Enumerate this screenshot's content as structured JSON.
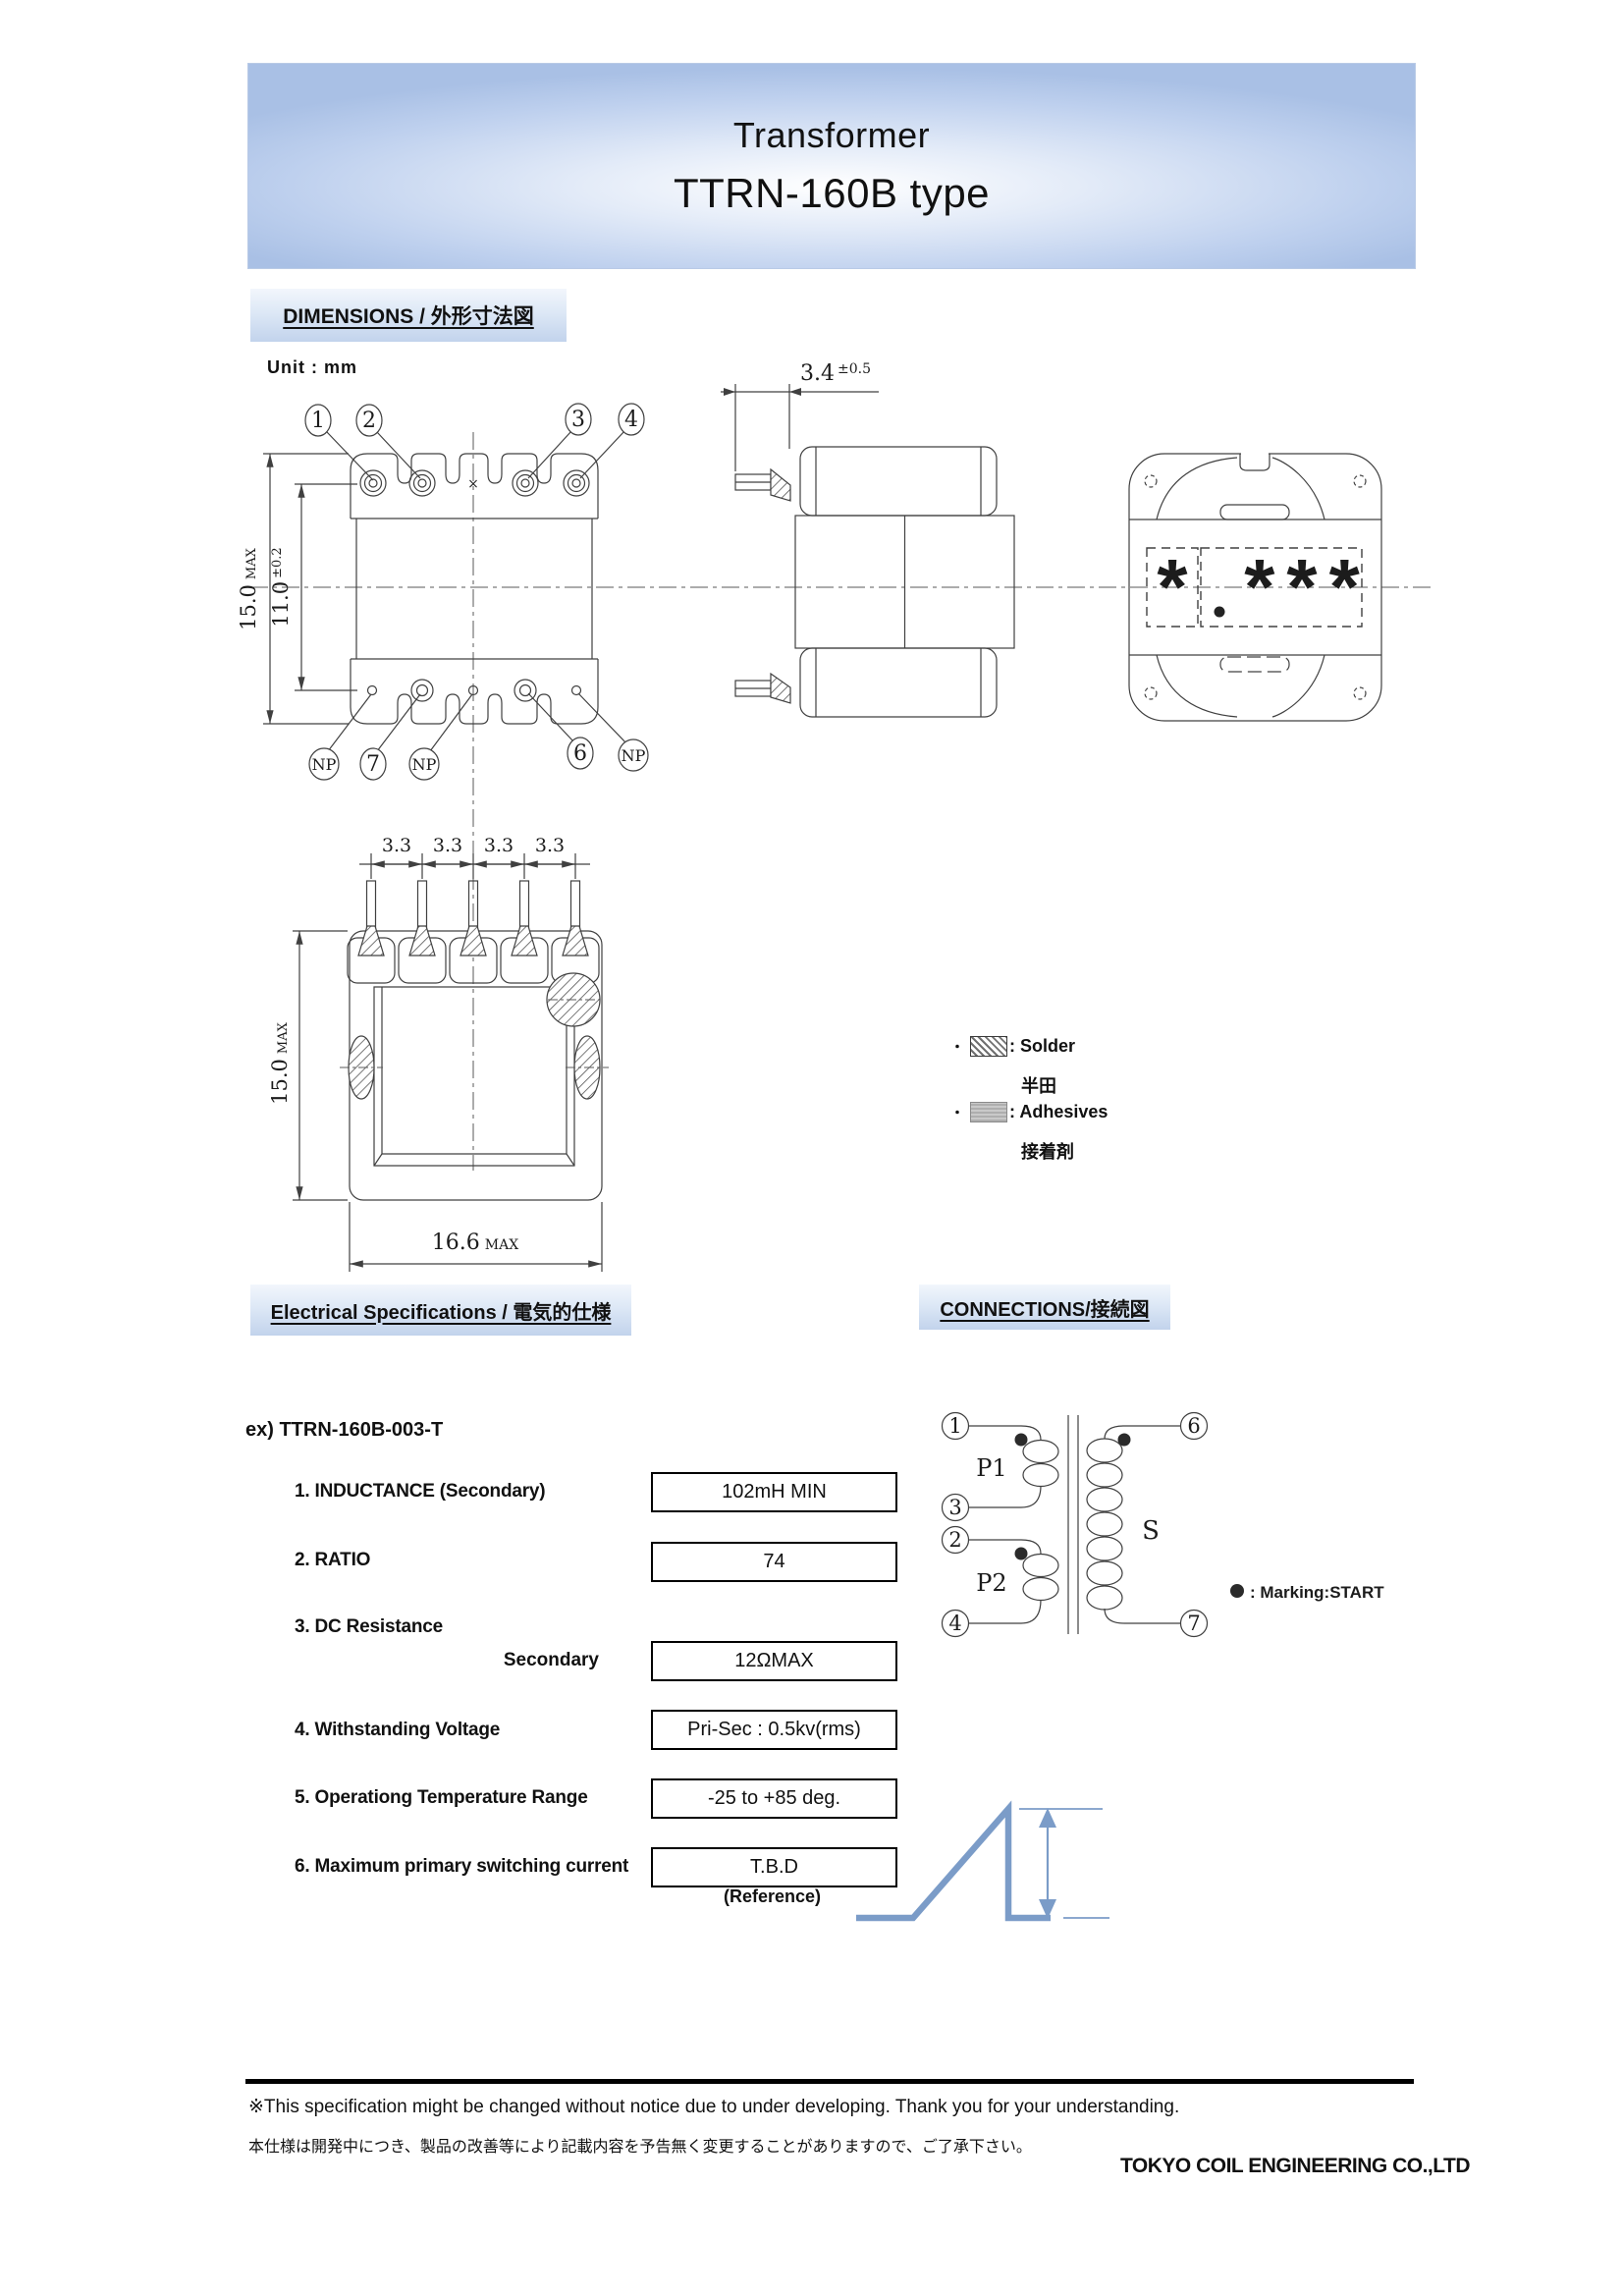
{
  "header": {
    "product": "Transformer",
    "model": "TTRN-160B type"
  },
  "section_dimensions": {
    "title": "DIMENSIONS / 外形寸法図",
    "unit_label": "Unit : mm"
  },
  "top_view": {
    "callouts_top": [
      "1",
      "2",
      "3",
      "4"
    ],
    "callouts_bottom": [
      "NP",
      "7",
      "NP",
      "6",
      "NP"
    ],
    "dim_outer": {
      "value": "15.0",
      "suffix": "MAX"
    },
    "dim_inner": {
      "value": "11.0",
      "suffix": "±0.2"
    },
    "center_mark": "×"
  },
  "side_view": {
    "dim_pin": {
      "value": "3.4",
      "suffix": "±0.5"
    }
  },
  "back_view": {
    "marking_left": "*",
    "marking_right": "***"
  },
  "front_view": {
    "pitch_labels": [
      "3.3",
      "3.3",
      "3.3",
      "3.3"
    ],
    "dim_height": {
      "value": "15.0",
      "suffix": "MAX"
    },
    "dim_width": {
      "value": "16.6",
      "suffix": "MAX"
    }
  },
  "legend": {
    "bullet": "・",
    "solder_label": ": Solder",
    "solder_jp": "半田",
    "adhesives_label": ": Adhesives",
    "adhesives_jp": "接着剤"
  },
  "section_electrical": {
    "title": "Electrical Specifications / 電気的仕様",
    "example": "ex) TTRN-160B-003-T"
  },
  "section_connections": {
    "title": "CONNECTIONS/接続図"
  },
  "specs": [
    {
      "label": "1. INDUCTANCE (Secondary)",
      "value": "102mH MIN"
    },
    {
      "label": "2. RATIO",
      "value": "74"
    },
    {
      "label": "3. DC Resistance",
      "sublabel": "Secondary",
      "value": "12ΩMAX"
    },
    {
      "label": "4. Withstanding Voltage",
      "value": "Pri-Sec : 0.5kv(rms)"
    },
    {
      "label": "5. Operationg Temperature Range",
      "value": "-25 to +85 deg."
    },
    {
      "label": "6. Maximum primary switching current",
      "value": "T.B.D",
      "note": "(Reference)"
    }
  ],
  "connections": {
    "windings": [
      {
        "name": "P1",
        "pin_start": "1",
        "pin_end": "3"
      },
      {
        "name": "P2",
        "pin_start": "2",
        "pin_end": "4"
      },
      {
        "name": "S",
        "pin_start": "6",
        "pin_end": "7"
      }
    ],
    "marking_note": ": Marking:START"
  },
  "footer": {
    "note_en": "※This specification might be changed without notice due to under developing. Thank you for your understanding.",
    "note_jp": "本仕様は開発中につき、製品の改善等により記載内容を予告無く変更することがありますので、ご了承下さい。",
    "company": "TOKYO COIL ENGINEERING CO.,LTD"
  },
  "colors": {
    "accent_band": "#c2d3ec",
    "waveform_blue": "#7b9cc8",
    "drawing_line": "#404040"
  }
}
